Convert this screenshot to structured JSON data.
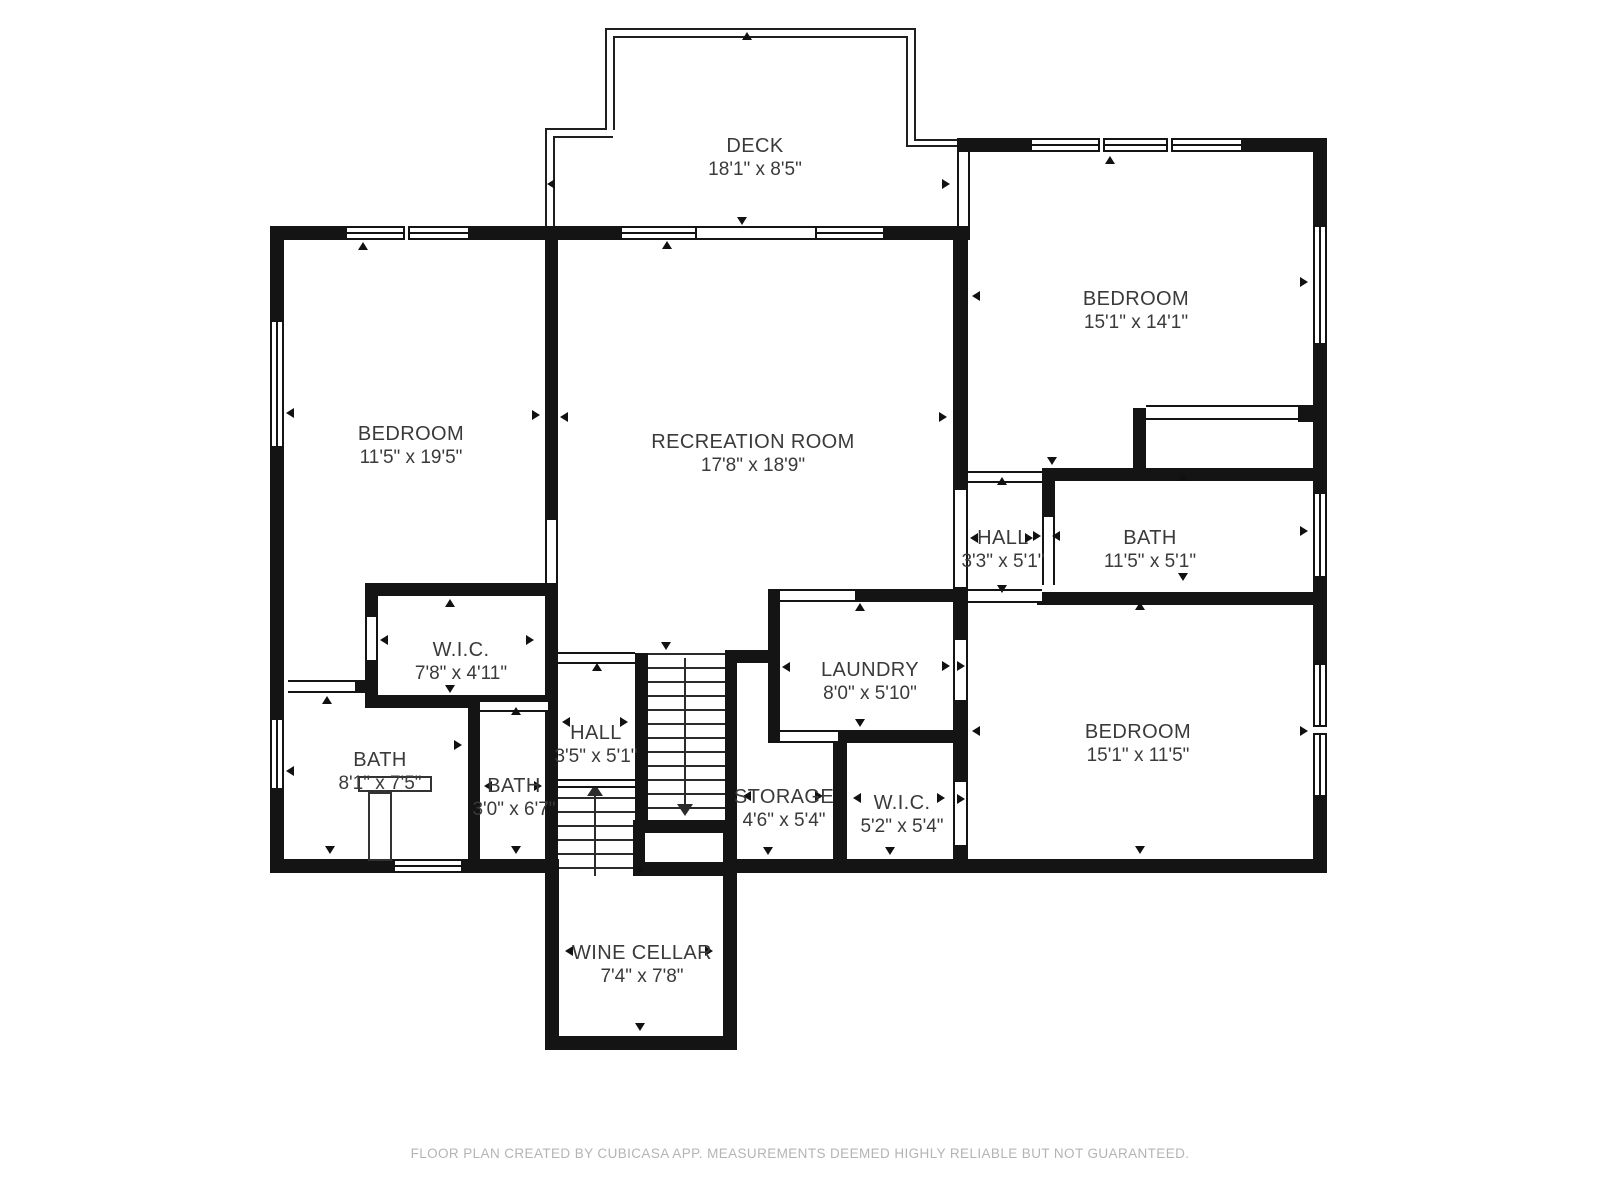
{
  "rooms": {
    "deck": {
      "name": "DECK",
      "dims": "18'1\" x 8'5\""
    },
    "bedroom_left": {
      "name": "BEDROOM",
      "dims": "11'5\" x 19'5\""
    },
    "recreation": {
      "name": "RECREATION ROOM",
      "dims": "17'8\" x 18'9\""
    },
    "bedroom_top_right": {
      "name": "BEDROOM",
      "dims": "15'1\" x 14'1\""
    },
    "hall_right": {
      "name": "HALL",
      "dims": "3'3\" x 5'1\""
    },
    "bath_right": {
      "name": "BATH",
      "dims": "11'5\" x 5'1\""
    },
    "wic_left": {
      "name": "W.I.C.",
      "dims": "7'8\" x 4'11\""
    },
    "laundry": {
      "name": "LAUNDRY",
      "dims": "8'0\" x 5'10\""
    },
    "hall_bottom": {
      "name": "HALL",
      "dims": "3'5\" x 5'1\""
    },
    "bath_left": {
      "name": "BATH",
      "dims": "8'1\" x 7'5\""
    },
    "bath_small": {
      "name": "BATH",
      "dims": "3'0\" x 6'7\""
    },
    "storage": {
      "name": "STORAGE",
      "dims": "4'6\" x 5'4\""
    },
    "wic_small": {
      "name": "W.I.C.",
      "dims": "5'2\" x 5'4\""
    },
    "bedroom_bottom_right": {
      "name": "BEDROOM",
      "dims": "15'1\" x 11'5\""
    },
    "wine_cellar": {
      "name": "WINE CELLAR",
      "dims": "7'4\" x 7'8\""
    }
  },
  "footer": {
    "text": "FLOOR PLAN CREATED BY CUBICASA APP. MEASUREMENTS DEEMED HIGHLY RELIABLE BUT NOT GUARANTEED."
  },
  "colors": {
    "wall": "#141414",
    "background": "#ffffff",
    "label": "#3a3a3a",
    "footer_text": "#b4b4b4"
  }
}
